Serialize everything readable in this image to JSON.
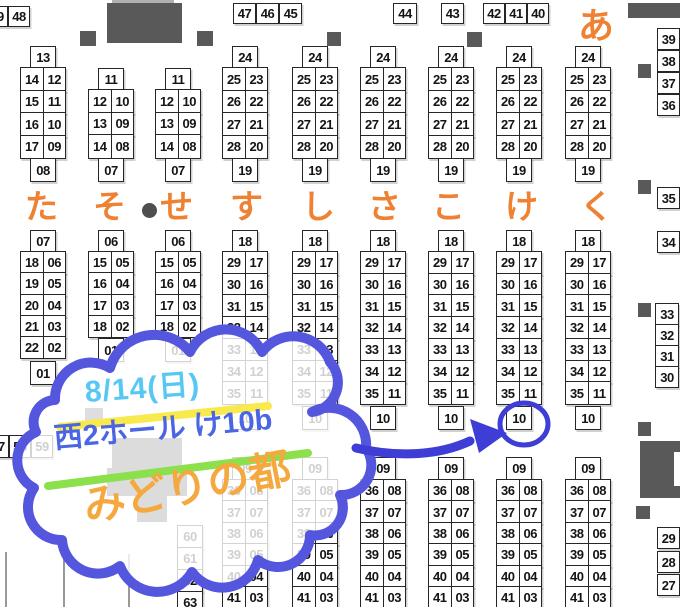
{
  "annotation": {
    "date_label": "8/14(日)",
    "place_label": "西2ホール け10b",
    "name_label": "みどりの都"
  },
  "area_labels": {
    "row_labels": [
      {
        "text": "た",
        "x": 25
      },
      {
        "text": "そ",
        "x": 93
      },
      {
        "text": "せ",
        "x": 160
      },
      {
        "text": "す",
        "x": 230
      },
      {
        "text": "し",
        "x": 302
      },
      {
        "text": "さ",
        "x": 368
      },
      {
        "text": "こ",
        "x": 432
      },
      {
        "text": "け",
        "x": 505
      },
      {
        "text": "く",
        "x": 580
      }
    ],
    "row_labels_y": 190,
    "row_labels_size": 33,
    "corner_label": {
      "text": "あ",
      "x": 578,
      "y": 8,
      "size": 36
    }
  },
  "booths": {
    "columns": [
      {
        "x": 20,
        "top": "13",
        "topY": 46,
        "rowsY": 67,
        "rowH": 22.5,
        "rows": [
          [
            "14",
            "12"
          ],
          [
            "15",
            "11"
          ],
          [
            "16",
            "10"
          ],
          [
            "17",
            "09"
          ]
        ],
        "bottom": "08",
        "bottomY": 158
      },
      {
        "x": 88,
        "top": "11",
        "topY": 68,
        "rowsY": 89,
        "rowH": 22.6,
        "rows": [
          [
            "12",
            "10"
          ],
          [
            "13",
            "09"
          ],
          [
            "14",
            "08"
          ]
        ],
        "bottom": "07",
        "bottomY": 158
      },
      {
        "x": 155,
        "top": "11",
        "topY": 68,
        "rowsY": 89,
        "rowH": 22.6,
        "rows": [
          [
            "12",
            "10"
          ],
          [
            "13",
            "09"
          ],
          [
            "14",
            "08"
          ]
        ],
        "bottom": "07",
        "bottomY": 158
      },
      {
        "x": 222,
        "top": "24",
        "topY": 46,
        "rowsY": 67,
        "rowH": 22.5,
        "rows": [
          [
            "25",
            "23"
          ],
          [
            "26",
            "22"
          ],
          [
            "27",
            "21"
          ],
          [
            "28",
            "20"
          ]
        ],
        "bottom": "19",
        "bottomY": 158
      },
      {
        "x": 292,
        "top": "24",
        "topY": 46,
        "rowsY": 67,
        "rowH": 22.5,
        "rows": [
          [
            "25",
            "23"
          ],
          [
            "26",
            "22"
          ],
          [
            "27",
            "21"
          ],
          [
            "28",
            "20"
          ]
        ],
        "bottom": "19",
        "bottomY": 158
      },
      {
        "x": 360,
        "top": "24",
        "topY": 46,
        "rowsY": 67,
        "rowH": 22.5,
        "rows": [
          [
            "25",
            "23"
          ],
          [
            "26",
            "22"
          ],
          [
            "27",
            "21"
          ],
          [
            "28",
            "20"
          ]
        ],
        "bottom": "19",
        "bottomY": 158
      },
      {
        "x": 428,
        "top": "24",
        "topY": 46,
        "rowsY": 67,
        "rowH": 22.5,
        "rows": [
          [
            "25",
            "23"
          ],
          [
            "26",
            "22"
          ],
          [
            "27",
            "21"
          ],
          [
            "28",
            "20"
          ]
        ],
        "bottom": "19",
        "bottomY": 158
      },
      {
        "x": 496,
        "top": "24",
        "topY": 46,
        "rowsY": 67,
        "rowH": 22.5,
        "rows": [
          [
            "25",
            "23"
          ],
          [
            "26",
            "22"
          ],
          [
            "27",
            "21"
          ],
          [
            "28",
            "20"
          ]
        ],
        "bottom": "19",
        "bottomY": 158
      },
      {
        "x": 565,
        "top": "24",
        "topY": 46,
        "rowsY": 67,
        "rowH": 22.5,
        "rows": [
          [
            "25",
            "23"
          ],
          [
            "26",
            "22"
          ],
          [
            "27",
            "21"
          ],
          [
            "28",
            "20"
          ]
        ],
        "bottom": "19",
        "bottomY": 158
      },
      {
        "x": 20,
        "top": "07",
        "topY": 230,
        "rowsY": 251,
        "rowH": 21.3,
        "rows": [
          [
            "18",
            "06"
          ],
          [
            "19",
            "05"
          ],
          [
            "20",
            "04"
          ],
          [
            "21",
            "03"
          ],
          [
            "22",
            "02"
          ]
        ],
        "bottom": "01",
        "bottomY": 361
      },
      {
        "x": 88,
        "top": "06",
        "topY": 230,
        "rowsY": 251,
        "rowH": 21.3,
        "rows": [
          [
            "15",
            "05"
          ],
          [
            "16",
            "04"
          ],
          [
            "17",
            "03"
          ],
          [
            "18",
            "02"
          ]
        ],
        "bottom": "01",
        "bottomY": 338
      },
      {
        "x": 155,
        "top": "06",
        "topY": 230,
        "rowsY": 251,
        "rowH": 21.3,
        "rows": [
          [
            "15",
            "05"
          ],
          [
            "16",
            "04"
          ],
          [
            "17",
            "03"
          ],
          [
            "18",
            "02"
          ]
        ],
        "bottom": "01",
        "bottomY": 338
      },
      {
        "x": 222,
        "top": "18",
        "topY": 230,
        "rowsY": 251,
        "rowH": 21.7,
        "rows": [
          [
            "29",
            "17"
          ],
          [
            "30",
            "16"
          ],
          [
            "31",
            "15"
          ],
          [
            "32",
            "14"
          ],
          [
            "33",
            "13"
          ],
          [
            "34",
            "12"
          ],
          [
            "35",
            "11"
          ]
        ],
        "bottom": "10",
        "bottomY": 406
      },
      {
        "x": 292,
        "top": "18",
        "topY": 230,
        "rowsY": 251,
        "rowH": 21.7,
        "rows": [
          [
            "29",
            "17"
          ],
          [
            "30",
            "16"
          ],
          [
            "31",
            "15"
          ],
          [
            "32",
            "14"
          ],
          [
            "33",
            "13"
          ],
          [
            "34",
            "12"
          ],
          [
            "35",
            "11"
          ]
        ],
        "bottom": "10",
        "bottomY": 406
      },
      {
        "x": 360,
        "top": "18",
        "topY": 230,
        "rowsY": 251,
        "rowH": 21.7,
        "rows": [
          [
            "29",
            "17"
          ],
          [
            "30",
            "16"
          ],
          [
            "31",
            "15"
          ],
          [
            "32",
            "14"
          ],
          [
            "33",
            "13"
          ],
          [
            "34",
            "12"
          ],
          [
            "35",
            "11"
          ]
        ],
        "bottom": "10",
        "bottomY": 406
      },
      {
        "x": 428,
        "top": "18",
        "topY": 230,
        "rowsY": 251,
        "rowH": 21.7,
        "rows": [
          [
            "29",
            "17"
          ],
          [
            "30",
            "16"
          ],
          [
            "31",
            "15"
          ],
          [
            "32",
            "14"
          ],
          [
            "33",
            "13"
          ],
          [
            "34",
            "12"
          ],
          [
            "35",
            "11"
          ]
        ],
        "bottom": "10",
        "bottomY": 406
      },
      {
        "x": 496,
        "top": "18",
        "topY": 230,
        "rowsY": 251,
        "rowH": 21.7,
        "rows": [
          [
            "29",
            "17"
          ],
          [
            "30",
            "16"
          ],
          [
            "31",
            "15"
          ],
          [
            "32",
            "14"
          ],
          [
            "33",
            "13"
          ],
          [
            "34",
            "12"
          ],
          [
            "35",
            "11"
          ]
        ],
        "bottom": "10",
        "bottomY": 406,
        "circled": true
      },
      {
        "x": 565,
        "top": "18",
        "topY": 230,
        "rowsY": 251,
        "rowH": 21.7,
        "rows": [
          [
            "29",
            "17"
          ],
          [
            "30",
            "16"
          ],
          [
            "31",
            "15"
          ],
          [
            "32",
            "14"
          ],
          [
            "33",
            "13"
          ],
          [
            "34",
            "12"
          ],
          [
            "35",
            "11"
          ]
        ],
        "bottom": "10",
        "bottomY": 406
      },
      {
        "x": 222,
        "top": "09",
        "topY": 457,
        "rowsY": 479,
        "rowH": 21.4,
        "rows": [
          [
            "36",
            "08"
          ],
          [
            "37",
            "07"
          ],
          [
            "38",
            "06"
          ],
          [
            "39",
            "05"
          ],
          [
            "40",
            "04"
          ],
          [
            "41",
            "03"
          ]
        ]
      },
      {
        "x": 292,
        "top": "09",
        "topY": 457,
        "rowsY": 479,
        "rowH": 21.4,
        "rows": [
          [
            "36",
            "08"
          ],
          [
            "37",
            "07"
          ],
          [
            "38",
            "06"
          ],
          [
            "39",
            "05"
          ],
          [
            "40",
            "04"
          ],
          [
            "41",
            "03"
          ]
        ]
      },
      {
        "x": 360,
        "top": "09",
        "topY": 457,
        "rowsY": 479,
        "rowH": 21.4,
        "rows": [
          [
            "36",
            "08"
          ],
          [
            "37",
            "07"
          ],
          [
            "38",
            "06"
          ],
          [
            "39",
            "05"
          ],
          [
            "40",
            "04"
          ],
          [
            "41",
            "03"
          ]
        ]
      },
      {
        "x": 428,
        "top": "09",
        "topY": 457,
        "rowsY": 479,
        "rowH": 21.4,
        "rows": [
          [
            "36",
            "08"
          ],
          [
            "37",
            "07"
          ],
          [
            "38",
            "06"
          ],
          [
            "39",
            "05"
          ],
          [
            "40",
            "04"
          ],
          [
            "41",
            "03"
          ]
        ]
      },
      {
        "x": 496,
        "top": "09",
        "topY": 457,
        "rowsY": 479,
        "rowH": 21.4,
        "rows": [
          [
            "36",
            "08"
          ],
          [
            "37",
            "07"
          ],
          [
            "38",
            "06"
          ],
          [
            "39",
            "05"
          ],
          [
            "40",
            "04"
          ],
          [
            "41",
            "03"
          ]
        ]
      },
      {
        "x": 565,
        "top": "09",
        "topY": 457,
        "rowsY": 479,
        "rowH": 21.4,
        "rows": [
          [
            "36",
            "08"
          ],
          [
            "37",
            "07"
          ],
          [
            "38",
            "06"
          ],
          [
            "39",
            "05"
          ],
          [
            "40",
            "04"
          ],
          [
            "41",
            "03"
          ]
        ]
      }
    ],
    "single_boxes": [
      {
        "t": "49",
        "x": -14,
        "y": 6,
        "w": 22,
        "h": 19
      },
      {
        "t": "48",
        "x": 8,
        "y": 6,
        "w": 22,
        "h": 19
      },
      {
        "t": "47",
        "x": 233,
        "y": 3,
        "w": 23,
        "h": 19
      },
      {
        "t": "46",
        "x": 256,
        "y": 3,
        "w": 23,
        "h": 19
      },
      {
        "t": "45",
        "x": 279,
        "y": 3,
        "w": 23,
        "h": 19
      },
      {
        "t": "44",
        "x": 393,
        "y": 3,
        "w": 24,
        "h": 19
      },
      {
        "t": "43",
        "x": 441,
        "y": 3,
        "w": 23,
        "h": 19
      },
      {
        "t": "42",
        "x": 483,
        "y": 3,
        "w": 22,
        "h": 19
      },
      {
        "t": "41",
        "x": 505,
        "y": 3,
        "w": 22,
        "h": 19
      },
      {
        "t": "40",
        "x": 527,
        "y": 3,
        "w": 22,
        "h": 19
      },
      {
        "t": "39",
        "x": 657,
        "y": 28,
        "w": 23,
        "h": 20
      },
      {
        "t": "38",
        "x": 657,
        "y": 50,
        "w": 23,
        "h": 20
      },
      {
        "t": "37",
        "x": 657,
        "y": 72,
        "w": 23,
        "h": 20
      },
      {
        "t": "36",
        "x": 657,
        "y": 94,
        "w": 23,
        "h": 20
      },
      {
        "t": "35",
        "x": 657,
        "y": 187,
        "w": 23,
        "h": 20
      },
      {
        "t": "34",
        "x": 657,
        "y": 231,
        "w": 23,
        "h": 20
      },
      {
        "t": "33",
        "x": 655,
        "y": 303,
        "w": 24,
        "h": 20
      },
      {
        "t": "32",
        "x": 655,
        "y": 324,
        "w": 24,
        "h": 20
      },
      {
        "t": "31",
        "x": 655,
        "y": 345,
        "w": 24,
        "h": 20
      },
      {
        "t": "30",
        "x": 655,
        "y": 366,
        "w": 24,
        "h": 20
      },
      {
        "t": "29",
        "x": 657,
        "y": 527,
        "w": 23,
        "h": 20
      },
      {
        "t": "28",
        "x": 657,
        "y": 551,
        "w": 23,
        "h": 20
      },
      {
        "t": "27",
        "x": 657,
        "y": 574,
        "w": 23,
        "h": 20
      },
      {
        "t": "57",
        "x": -13,
        "y": 435,
        "w": 22,
        "h": 21
      },
      {
        "t": "58",
        "x": 9,
        "y": 435,
        "w": 22,
        "h": 21
      },
      {
        "t": "59",
        "x": 31,
        "y": 435,
        "w": 22,
        "h": 21
      },
      {
        "t": "60",
        "x": 177,
        "y": 525,
        "w": 26,
        "h": 21
      },
      {
        "t": "61",
        "x": 177,
        "y": 547,
        "w": 26,
        "h": 21
      },
      {
        "t": "62",
        "x": 177,
        "y": 569,
        "w": 26,
        "h": 21
      },
      {
        "t": "63",
        "x": 177,
        "y": 591,
        "w": 26,
        "h": 21
      }
    ]
  },
  "structures": {
    "shapes": [
      {
        "name": "stage-backwall",
        "x": 112,
        "y": 0,
        "w": 62,
        "h": 9,
        "color": "#b3b0b0"
      },
      {
        "name": "stage-block",
        "x": 107,
        "y": 3,
        "w": 75,
        "h": 40,
        "color": "#595959"
      },
      {
        "name": "wall-top-right",
        "x": 628,
        "y": 3,
        "w": 52,
        "h": 15,
        "color": "#595959"
      },
      {
        "name": "pillar",
        "x": 80,
        "y": 31,
        "w": 16,
        "h": 15,
        "color": "#595959"
      },
      {
        "name": "pillar",
        "x": 197,
        "y": 31,
        "w": 16,
        "h": 15,
        "color": "#595959"
      },
      {
        "name": "pillar",
        "x": 327,
        "y": 32,
        "w": 14,
        "h": 14,
        "color": "#595959"
      },
      {
        "name": "pillar",
        "x": 467,
        "y": 32,
        "w": 15,
        "h": 15,
        "color": "#595959"
      },
      {
        "name": "pillar",
        "x": 638,
        "y": 64,
        "w": 13,
        "h": 14,
        "color": "#595959"
      },
      {
        "name": "pillar",
        "x": 638,
        "y": 180,
        "w": 13,
        "h": 14,
        "color": "#595959"
      },
      {
        "name": "pillar",
        "x": 638,
        "y": 303,
        "w": 13,
        "h": 14,
        "color": "#595959"
      },
      {
        "name": "pillar",
        "x": 638,
        "y": 422,
        "w": 13,
        "h": 14,
        "color": "#595959"
      },
      {
        "name": "pillar",
        "x": 636,
        "y": 506,
        "w": 14,
        "h": 13,
        "color": "#595959"
      },
      {
        "name": "pillar",
        "x": 85,
        "y": 408,
        "w": 18,
        "h": 19,
        "color": "#595959"
      },
      {
        "name": "structure-center",
        "x": 112,
        "y": 438,
        "w": 70,
        "h": 34,
        "color": "#4f4f4f"
      },
      {
        "name": "structure-center",
        "x": 107,
        "y": 468,
        "w": 80,
        "h": 28,
        "color": "#4f4f4f"
      },
      {
        "name": "structure-center",
        "x": 137,
        "y": 494,
        "w": 30,
        "h": 28,
        "color": "#4f4f4f"
      },
      {
        "name": "structure-right",
        "x": 640,
        "y": 441,
        "w": 40,
        "h": 57,
        "color": "#595959"
      },
      {
        "name": "structure-right-notch",
        "x": 674,
        "y": 452,
        "w": 6,
        "h": 34,
        "color": "#ffffff"
      }
    ],
    "aisle_dot": {
      "x": 142,
      "y": 203,
      "d": 15
    },
    "partial_lines": [
      {
        "x": 5,
        "y": 552,
        "h": 55
      },
      {
        "x": 63,
        "y": 548,
        "h": 59
      },
      {
        "x": 128,
        "y": 554,
        "h": 53
      }
    ]
  },
  "colors": {
    "label_orange": "#ee8132",
    "cloud_stroke": "#5456dd",
    "cloud_fill_alpha": 0.8,
    "arrow_blue": "#3e3ed6",
    "date_blue": "#56c8f3",
    "underline_yellow": "#f8ea4d",
    "place_blue": "#4a66e4",
    "underline_green": "#8ce04b",
    "name_orange": "#f5a83d",
    "structure_gray": "#595959",
    "booth_border": "#262626"
  }
}
